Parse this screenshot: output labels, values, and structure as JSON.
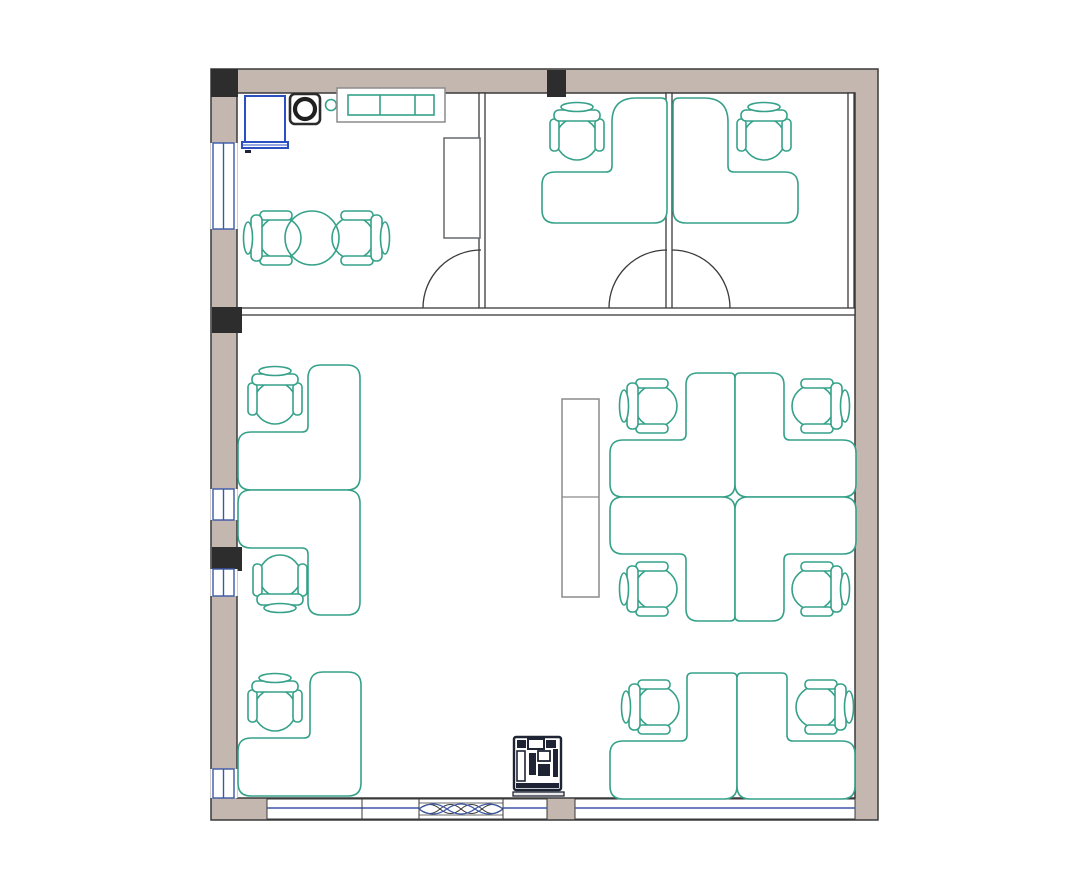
{
  "meta": {
    "title": "Office floor plan",
    "description": "Top-view architectural floor plan of an office suite with a break room, two private offices and an open office area",
    "canvas": {
      "width_px": 1080,
      "height_px": 874,
      "background": "#ffffff"
    }
  },
  "palette": {
    "wall_fill": "#c3b7b0",
    "wall_stroke": "#3a3a3a",
    "column_fill": "#2d2d2d",
    "furniture_stroke": "#35a189",
    "window_blue": "#3b57a8",
    "cabinet_blue": "#2b4fc0",
    "storage_stroke": "#8b8b8b",
    "copier_color": "#1e2433"
  },
  "inventory": {
    "rooms": [
      {
        "name": "break-room-top-left",
        "items": [
          "blue-cabinet",
          "coffee-machine",
          "stool",
          "wall-shelf-unit",
          "tall-cabinet",
          "round-table",
          "2 chairs",
          "door"
        ]
      },
      {
        "name": "private-office-left",
        "items": [
          "l-shaped-desk",
          "office-chair",
          "door"
        ]
      },
      {
        "name": "private-office-right",
        "items": [
          "l-shaped-desk",
          "office-chair",
          "door"
        ]
      },
      {
        "name": "open-office-area",
        "items": [
          "3 l-shaped-desks left row",
          "4-desk quad cluster",
          "2 l-shaped-desks bottom right",
          "9 office-chairs",
          "storage-cabinet",
          "copier"
        ]
      }
    ],
    "counts": {
      "l_shaped_desks": 11,
      "office_chairs": 13,
      "round_tables": 1,
      "doors": 3,
      "left_wall_windows": 4,
      "bottom_wall_windows": 3,
      "wave_glazing_panels": 1,
      "structural_columns": 4,
      "copiers": 1,
      "storage_units": 4
    }
  }
}
